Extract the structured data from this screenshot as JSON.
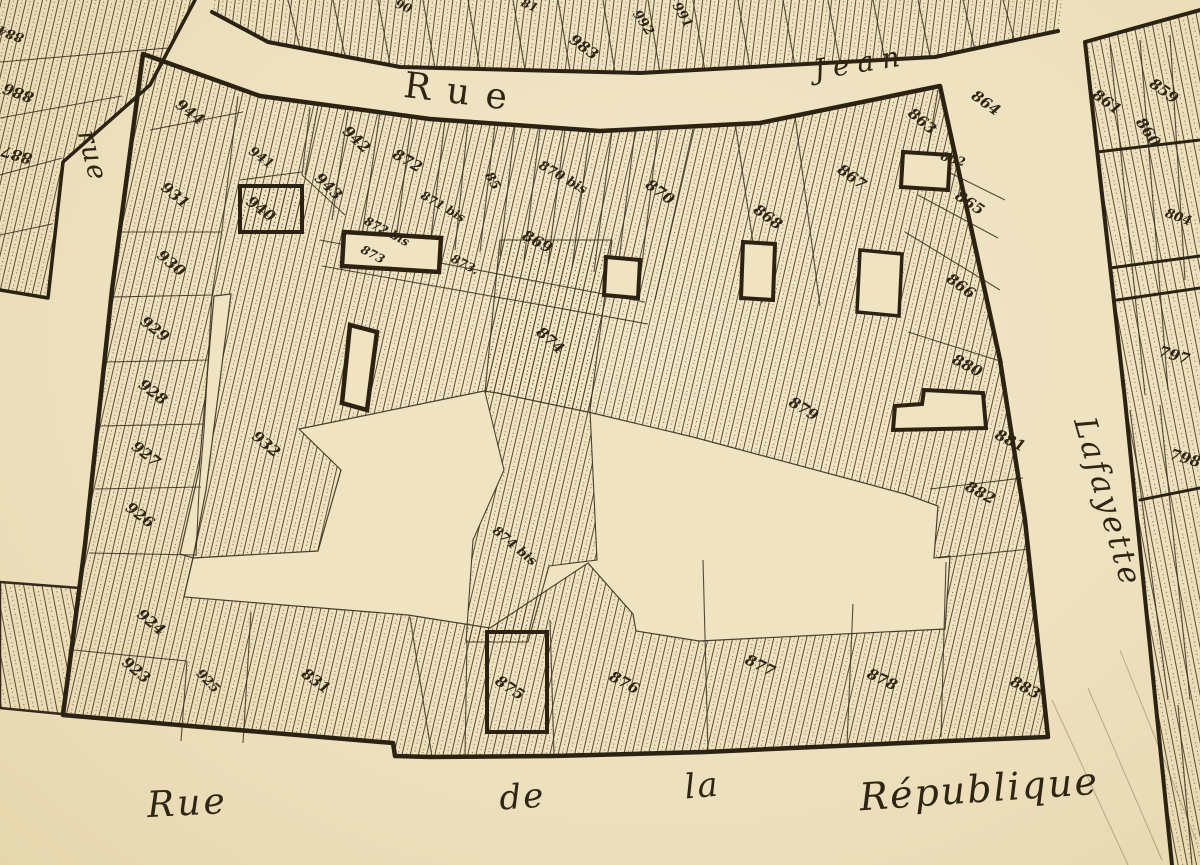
{
  "map": {
    "type": "scanned cadastral parcel map",
    "colors": {
      "paper": "#efe3c2",
      "paper_light": "#f2e7ca",
      "ink": "#34291a",
      "hatch": "#4a3b23"
    },
    "street_labels": [
      {
        "name": "rue-jean-word-rue",
        "text": "Rue",
        "x": 462,
        "y": 104,
        "rot": 7,
        "size": 36,
        "ls": 16,
        "cls": "print"
      },
      {
        "name": "rue-jean-word-jean",
        "text": "Jean",
        "x": 862,
        "y": 72,
        "rot": -9,
        "size": 28,
        "ls": 8,
        "cls": "print-italic"
      },
      {
        "name": "rue-left",
        "text": "rue",
        "x": 84,
        "y": 158,
        "rot": 76,
        "size": 27,
        "ls": 2,
        "cls": "script"
      },
      {
        "name": "lafayette",
        "text": "Lafayette",
        "x": 1098,
        "y": 505,
        "rot": 74,
        "size": 31,
        "ls": 3,
        "cls": "script"
      },
      {
        "name": "republique-rue",
        "text": "Rue",
        "x": 188,
        "y": 815,
        "rot": -3,
        "size": 36,
        "ls": 3,
        "cls": "script"
      },
      {
        "name": "republique-de",
        "text": "de",
        "x": 523,
        "y": 808,
        "rot": -4,
        "size": 34,
        "ls": 2,
        "cls": "script"
      },
      {
        "name": "republique-la",
        "text": "la",
        "x": 703,
        "y": 797,
        "rot": -5,
        "size": 34,
        "ls": 2,
        "cls": "script"
      },
      {
        "name": "republique-word",
        "text": "République",
        "x": 980,
        "y": 802,
        "rot": -4,
        "size": 38,
        "ls": 2,
        "cls": "script"
      }
    ],
    "parcel_labels": [
      {
        "t": "944",
        "x": 187,
        "y": 116,
        "r": 38
      },
      {
        "t": "941",
        "x": 259,
        "y": 161,
        "r": 36,
        "s": 13
      },
      {
        "t": "940",
        "x": 258,
        "y": 213,
        "r": 36
      },
      {
        "t": "942",
        "x": 353,
        "y": 143,
        "r": 44
      },
      {
        "t": "943",
        "x": 325,
        "y": 190,
        "r": 44
      },
      {
        "t": "931",
        "x": 172,
        "y": 199,
        "r": 40
      },
      {
        "t": "930",
        "x": 168,
        "y": 267,
        "r": 40
      },
      {
        "t": "929",
        "x": 152,
        "y": 333,
        "r": 38
      },
      {
        "t": "928",
        "x": 150,
        "y": 396,
        "r": 38
      },
      {
        "t": "927",
        "x": 143,
        "y": 458,
        "r": 38
      },
      {
        "t": "926",
        "x": 137,
        "y": 519,
        "r": 38
      },
      {
        "t": "924",
        "x": 148,
        "y": 626,
        "r": 40
      },
      {
        "t": "923",
        "x": 133,
        "y": 674,
        "r": 40
      },
      {
        "t": "925",
        "x": 205,
        "y": 684,
        "r": 46,
        "s": 13
      },
      {
        "t": "932",
        "x": 263,
        "y": 448,
        "r": 40
      },
      {
        "t": "831",
        "x": 313,
        "y": 685,
        "r": 36
      },
      {
        "t": "872",
        "x": 405,
        "y": 165,
        "r": 30
      },
      {
        "t": "871 bis",
        "x": 441,
        "y": 210,
        "r": 30,
        "s": 12
      },
      {
        "t": "872 bis",
        "x": 385,
        "y": 235,
        "r": 28,
        "s": 12
      },
      {
        "t": "873",
        "x": 371,
        "y": 258,
        "r": 28,
        "s": 12
      },
      {
        "t": "873.",
        "x": 463,
        "y": 268,
        "r": 28,
        "s": 12
      },
      {
        "t": "85",
        "x": 489,
        "y": 183,
        "r": 60,
        "s": 13
      },
      {
        "t": "870 bis",
        "x": 561,
        "y": 181,
        "r": 30,
        "s": 13
      },
      {
        "t": "870",
        "x": 657,
        "y": 196,
        "r": 36
      },
      {
        "t": "869",
        "x": 535,
        "y": 246,
        "r": 28
      },
      {
        "t": "874",
        "x": 547,
        "y": 344,
        "r": 42
      },
      {
        "t": "874 bis",
        "x": 512,
        "y": 549,
        "r": 40,
        "s": 13
      },
      {
        "t": "875",
        "x": 507,
        "y": 692,
        "r": 34
      },
      {
        "t": "876",
        "x": 622,
        "y": 687,
        "r": 28
      },
      {
        "t": "877",
        "x": 758,
        "y": 670,
        "r": 26
      },
      {
        "t": "878",
        "x": 880,
        "y": 684,
        "r": 26
      },
      {
        "t": "883",
        "x": 1023,
        "y": 692,
        "r": 28
      },
      {
        "t": "867",
        "x": 849,
        "y": 181,
        "r": 36
      },
      {
        "t": "868",
        "x": 765,
        "y": 221,
        "r": 36
      },
      {
        "t": "864",
        "x": 983,
        "y": 107,
        "r": 36
      },
      {
        "t": "863",
        "x": 919,
        "y": 125,
        "r": 40
      },
      {
        "t": "862",
        "x": 952,
        "y": 163,
        "r": 16,
        "s": 12
      },
      {
        "t": "865",
        "x": 967,
        "y": 207,
        "r": 34
      },
      {
        "t": "866",
        "x": 958,
        "y": 290,
        "r": 36
      },
      {
        "t": "880",
        "x": 965,
        "y": 370,
        "r": 28
      },
      {
        "t": "879",
        "x": 801,
        "y": 413,
        "r": 32
      },
      {
        "t": "881",
        "x": 1008,
        "y": 445,
        "r": 26
      },
      {
        "t": "882",
        "x": 978,
        "y": 497,
        "r": 28
      },
      {
        "t": "983",
        "x": 581,
        "y": 51,
        "r": 36
      },
      {
        "t": "992",
        "x": 640,
        "y": 25,
        "r": 56,
        "s": 13
      },
      {
        "t": "991",
        "x": 679,
        "y": 17,
        "r": 60,
        "s": 13
      },
      {
        "t": "90",
        "x": 402,
        "y": 10,
        "r": 22,
        "s": 12
      },
      {
        "t": "81",
        "x": 528,
        "y": 9,
        "r": 24,
        "s": 12
      },
      {
        "t": "884",
        "x": 12,
        "y": 30,
        "r": 200,
        "s": 13
      },
      {
        "t": "886",
        "x": 20,
        "y": 88,
        "r": 200
      },
      {
        "t": "887",
        "x": 18,
        "y": 150,
        "r": 196
      },
      {
        "t": "861",
        "x": 1104,
        "y": 106,
        "r": 36
      },
      {
        "t": "859",
        "x": 1161,
        "y": 95,
        "r": 36
      },
      {
        "t": "860",
        "x": 1144,
        "y": 135,
        "r": 56
      },
      {
        "t": "804",
        "x": 1177,
        "y": 221,
        "r": 20,
        "s": 13
      },
      {
        "t": "797",
        "x": 1173,
        "y": 360,
        "r": 16
      },
      {
        "t": "798",
        "x": 1184,
        "y": 463,
        "r": 16
      }
    ]
  }
}
